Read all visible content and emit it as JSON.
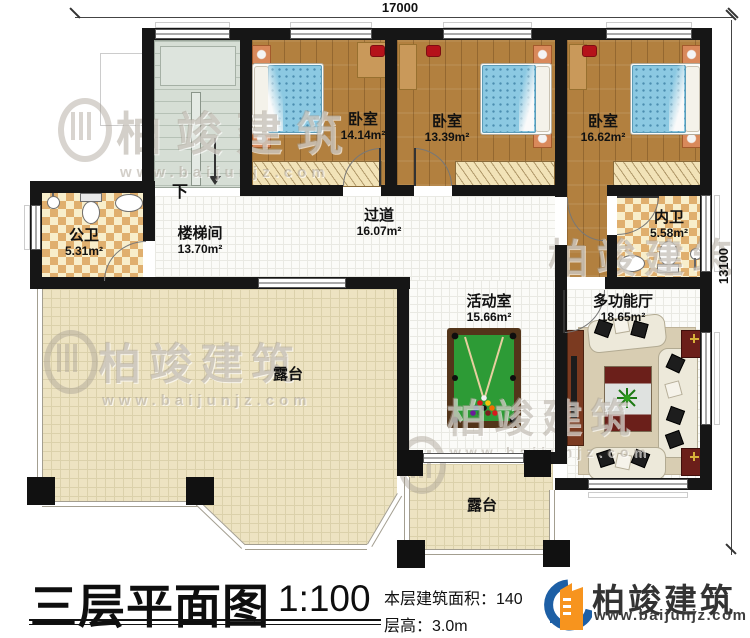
{
  "dimensions": {
    "top_width": "17000",
    "right_height": "13100"
  },
  "stairs": {
    "down_label": "下"
  },
  "rooms": {
    "stairwell": {
      "label": "楼梯间",
      "area": "13.70m²"
    },
    "public_bathroom": {
      "label": "公卫",
      "area": "5.31m²"
    },
    "bedroom_left": {
      "label": "卧室",
      "area": "14.14m²"
    },
    "bedroom_middle": {
      "label": "卧室",
      "area": "13.39m²"
    },
    "bedroom_right": {
      "label": "卧室",
      "area": "16.62m²"
    },
    "corridor": {
      "label": "过道",
      "area": "16.07m²"
    },
    "inner_bathroom": {
      "label": "内卫",
      "area": "5.58m²"
    },
    "activity_room": {
      "label": "活动室",
      "area": "15.66m²"
    },
    "multifunction_hall": {
      "label": "多功能厅",
      "area": "18.65m²"
    },
    "terrace_left": {
      "label": "露台"
    },
    "terrace_bottom": {
      "label": "露台"
    }
  },
  "title_block": {
    "title": "三层平面图",
    "scale": "1:100",
    "area_line": "本层建筑面积：140",
    "height_line": "层高：3.0m"
  },
  "branding": {
    "company": "柏竣建筑",
    "website": "www.baijunjz.com",
    "logo_blue": "#1d5fa5",
    "logo_orange": "#f7941e"
  },
  "watermark": {
    "company": "柏竣建筑",
    "website": "www.baijunjz.com"
  }
}
